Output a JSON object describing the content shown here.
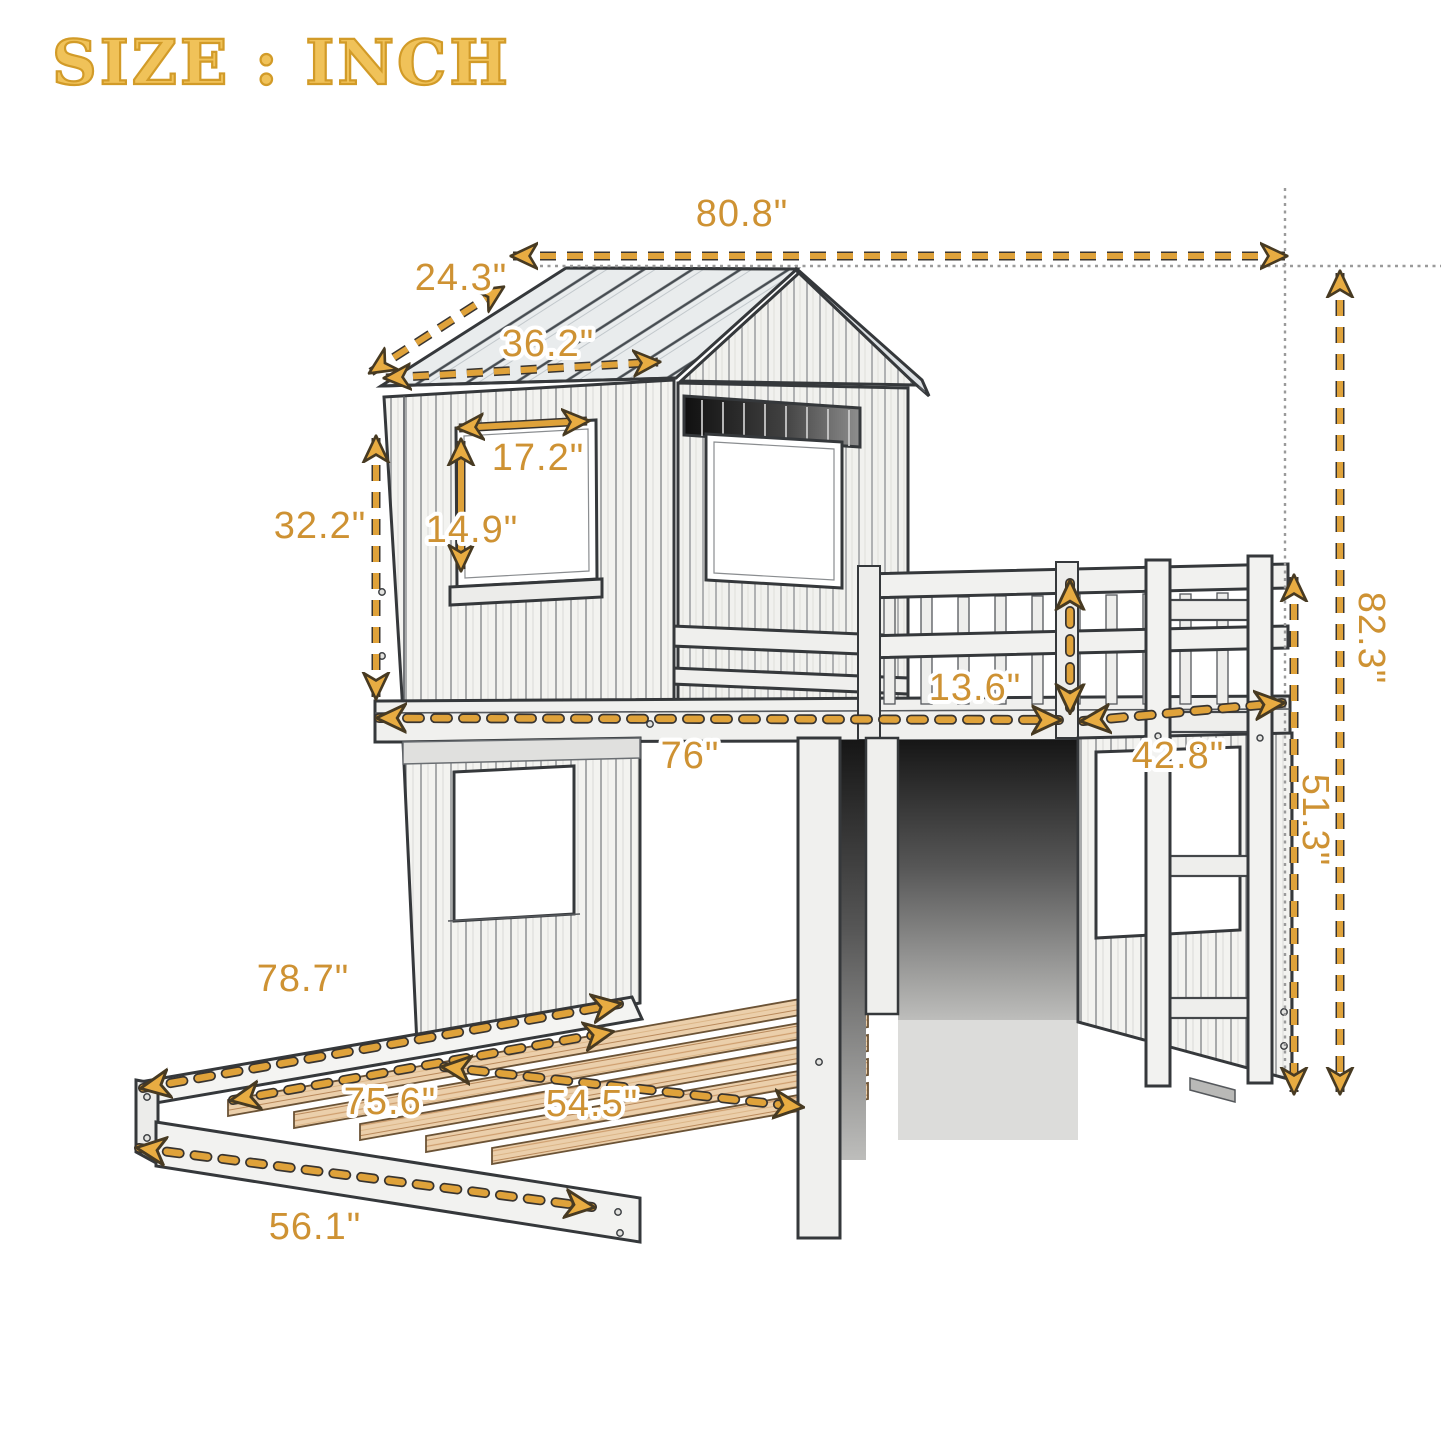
{
  "title": "SIZE : INCH",
  "unit": "INCH",
  "colors": {
    "dimension_line": "#DFA23A",
    "dimension_arrowhead": "#E8AC42",
    "dimension_text": "#CE9233",
    "title_gold": "#D29B28",
    "reference_line_gray": "#9A9A9A",
    "sketch_line": "#35383B",
    "wood_slat": "#EBCFAB"
  },
  "dimensions": {
    "overall_width": "80.8\"",
    "roof_slope_depth": "24.3\"",
    "roof_edge_length": "36.2\"",
    "window_width": "17.2\"",
    "window_height": "14.9\"",
    "upper_section_height": "32.2\"",
    "total_height": "82.3\"",
    "guardrail_height": "13.6\"",
    "bunk_length": "76\"",
    "loft_end_depth": "42.8\"",
    "under_loft_height": "51.3\"",
    "lower_bed_length": "78.7\"",
    "slat_length": "75.6\"",
    "slat_span": "54.5\"",
    "lower_bed_width": "56.1\""
  }
}
